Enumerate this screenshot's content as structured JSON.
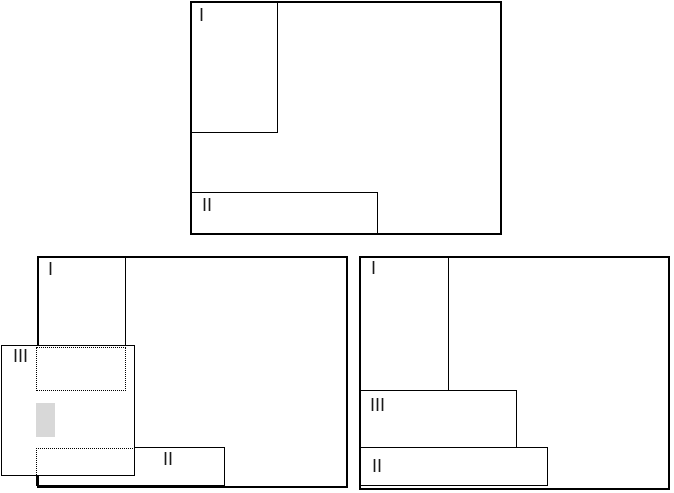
{
  "diagram": {
    "colors": {
      "background": "#ffffff",
      "line": "#000000",
      "label": "#1a1a1a",
      "shaded_fill": "#d8d8d8"
    },
    "panels": {
      "top": {
        "window_1_label": "I",
        "window_2_label": "II"
      },
      "bottom_left": {
        "window_1_label": "I",
        "window_2_label": "II",
        "window_3_label": "III"
      },
      "bottom_right": {
        "window_1_label": "I",
        "window_2_label": "II",
        "window_3_label": "III"
      }
    }
  }
}
